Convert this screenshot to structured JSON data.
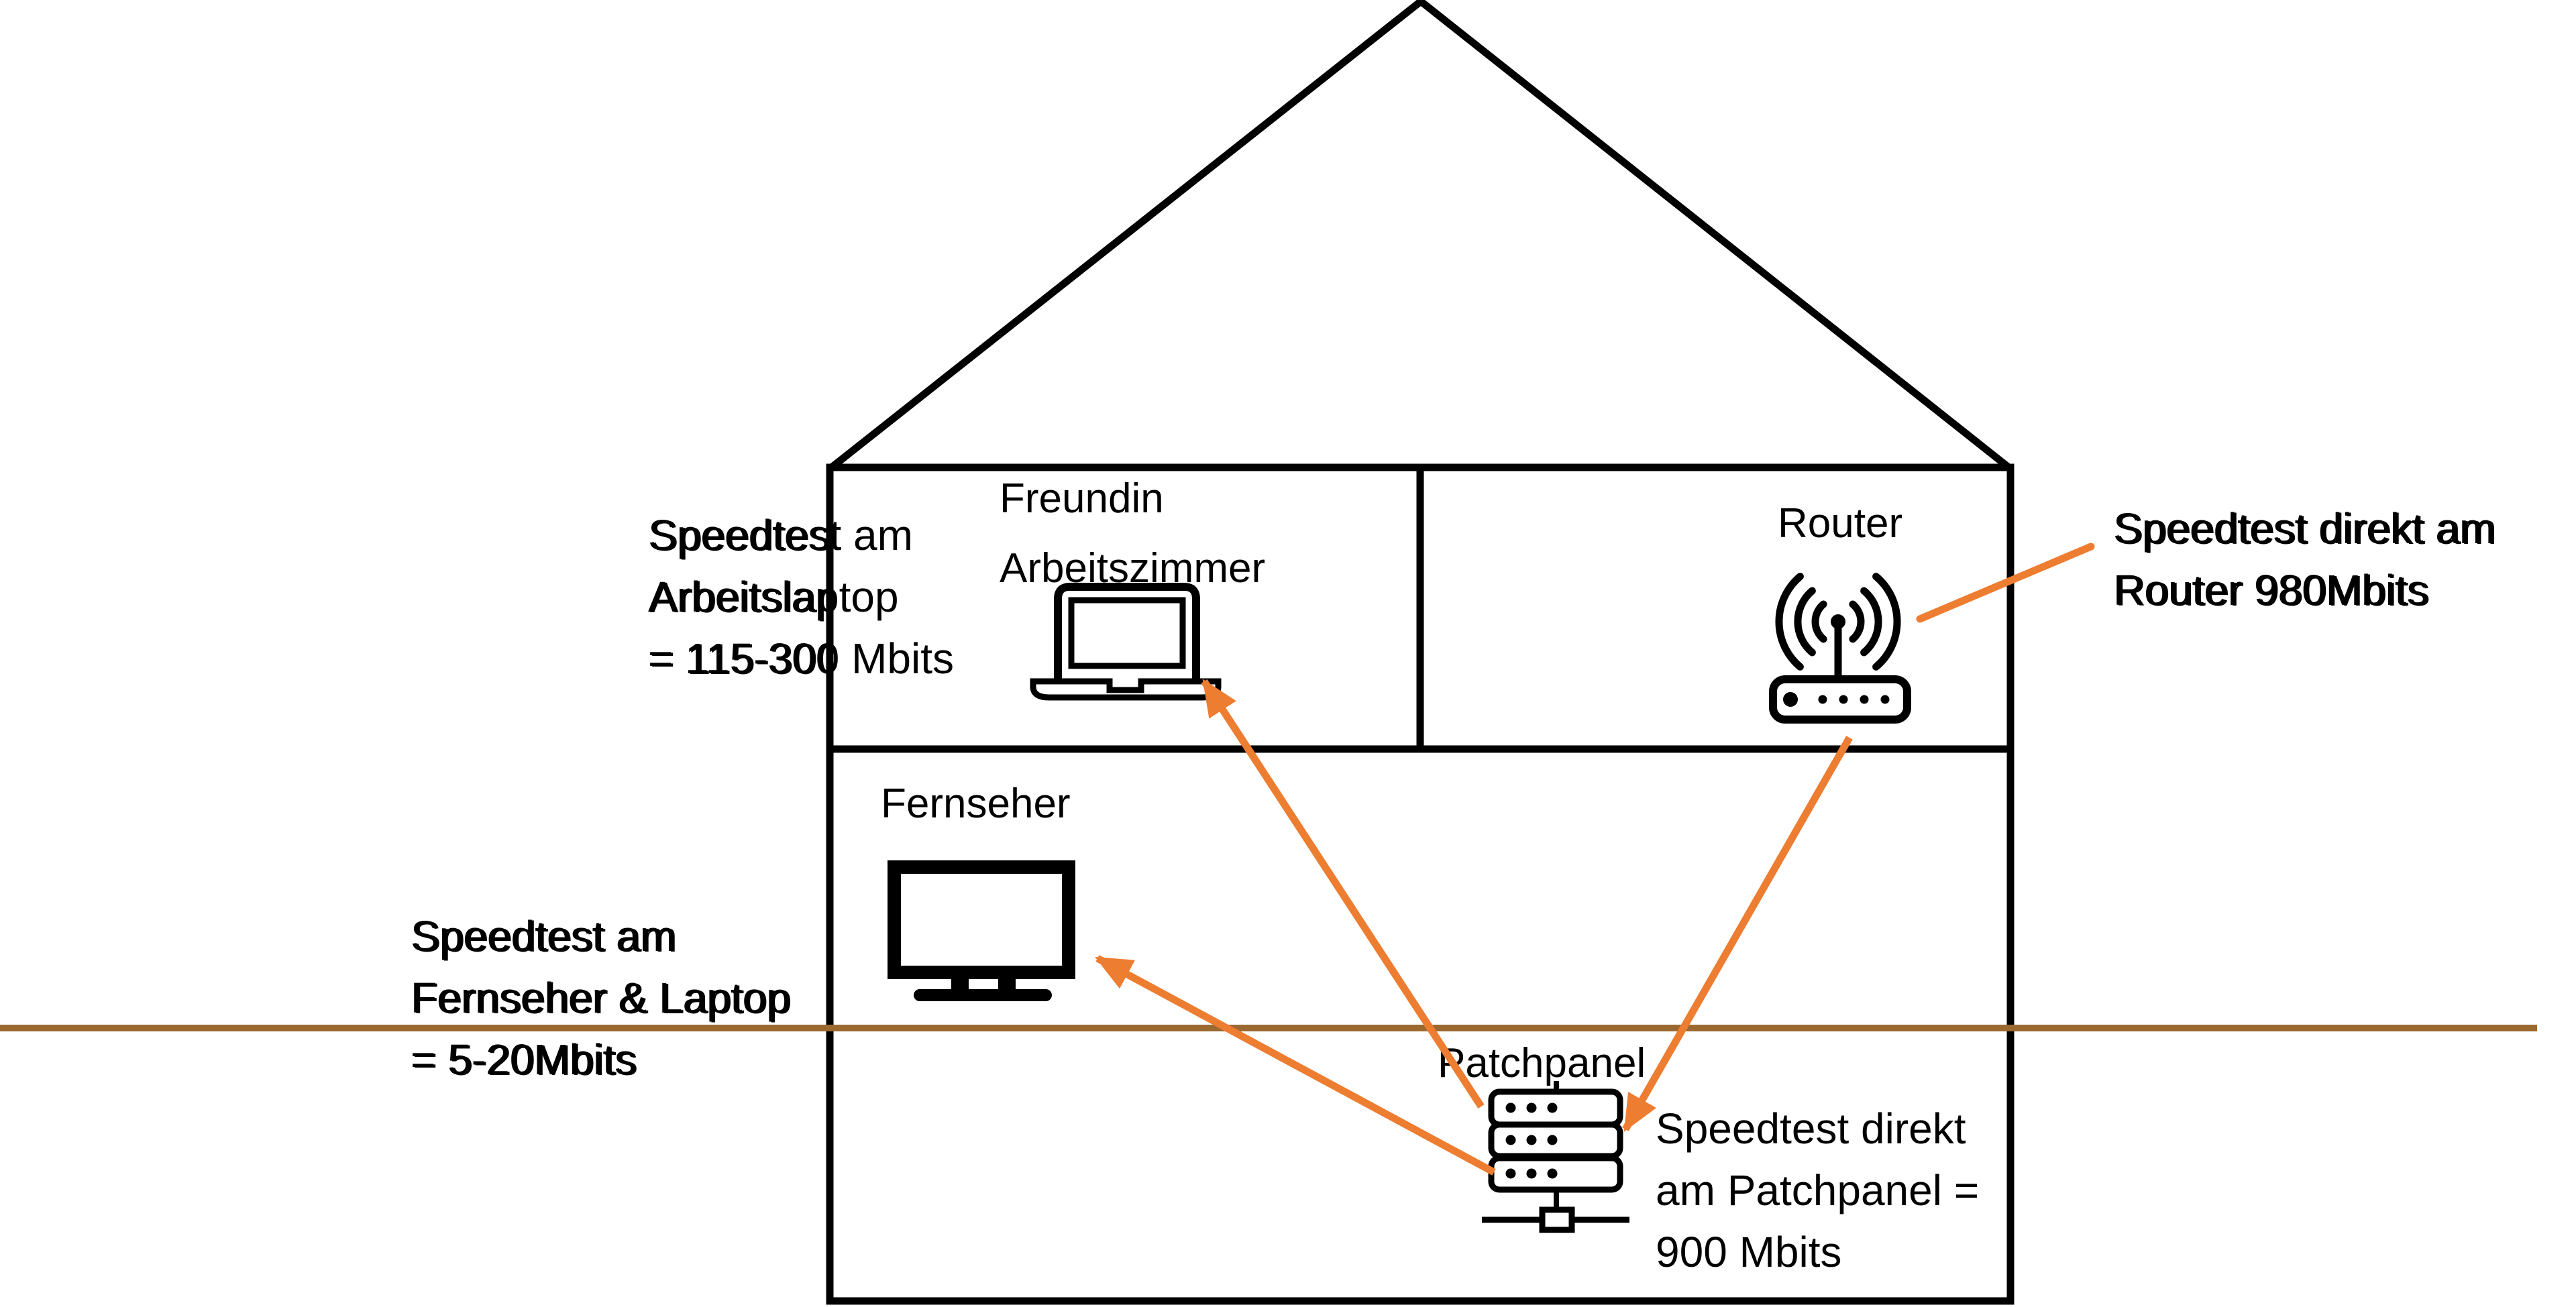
{
  "diagram": {
    "type": "home-network-house-diagram",
    "language": "de"
  },
  "annotations": {
    "arbeitslaptop": {
      "text": "Speedtest am\nArbeitslaptop\n= 115-300 Mbits"
    },
    "fernseher_laptop": {
      "text": "Speedtest am\nFernseher & Laptop\n= 5-20Mbits"
    },
    "router": {
      "text": "Speedtest direkt am\nRouter 980Mbits"
    },
    "patchpanel": {
      "text": "Speedtest direkt\nam Patchpanel =\n900 Mbits"
    }
  },
  "rooms": {
    "arbeitszimmer": {
      "label": "Freundin\nArbeitszimmer"
    },
    "router_room": {
      "label": "Router"
    },
    "wohnzimmer": {
      "label": "Fernseher"
    },
    "keller": {
      "label": "Patchpanel"
    }
  },
  "icons": {
    "laptop": "laptop-icon",
    "router": "wifi-router-icon",
    "tv": "tv-icon",
    "patchpanel": "patchpanel-rack-icon"
  },
  "colors": {
    "arrow": "#ED7D31",
    "ground_line": "#9B6930",
    "outline": "#000000"
  }
}
